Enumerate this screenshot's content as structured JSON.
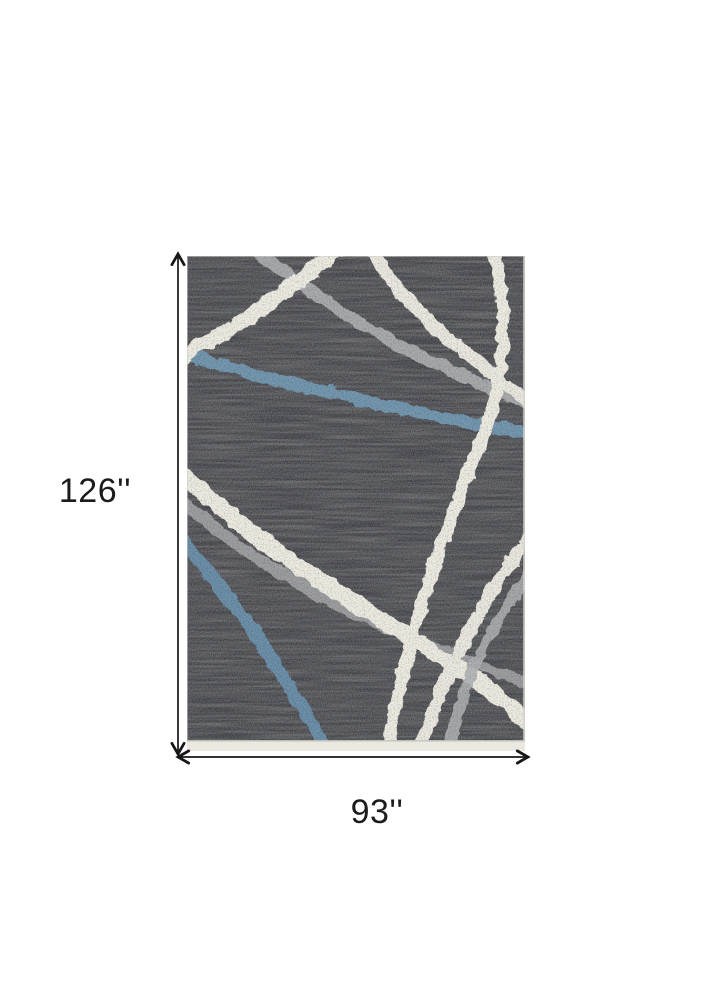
{
  "page": {
    "background_color": "#ffffff"
  },
  "dimensions": {
    "height_label": "126''",
    "width_label": "93''"
  },
  "rug": {
    "description": "dark charcoal heathered area rug with abstract crossing stripes",
    "colors": {
      "base": "#313237",
      "ivory": "#eceade",
      "ivory_soft": "#e9e6dc",
      "gray": "#a4a6a8",
      "gray_mid": "#97999c",
      "blue_upper": "#5b86a2",
      "blue_lower": "#527d9b",
      "binding": "#eae8e1",
      "edge_highlight": "#d8d6cf"
    }
  },
  "annotation": {
    "arrow_color": "#161616",
    "label_color": "#1b1b1b"
  }
}
